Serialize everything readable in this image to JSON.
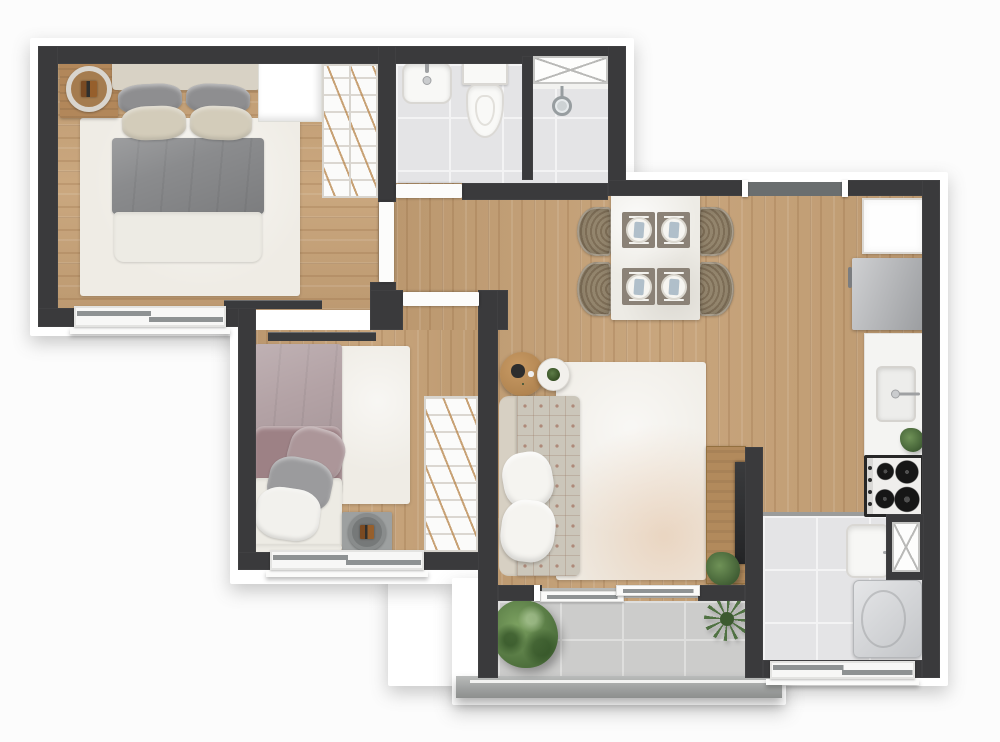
{
  "meta": {
    "type": "apartment-floor-plan",
    "canvas_width": 1000,
    "canvas_height": 742
  },
  "palette": {
    "background": "#fcfcfc",
    "wall": "#3a3a3c",
    "wood_floor": "#c5a075",
    "bathroom_tile": "#e4e4e6",
    "balcony_tile": "#cccccb",
    "rug": "#efece5",
    "sofa": "#cbc6ba",
    "bed1_duvet": "#8a8b8d",
    "bed2_duvet": "#b3a2a5",
    "plant_green": "#4d6f3c",
    "fixture_white": "#f8f8f6",
    "entry_mat": "#6a6e6f"
  },
  "scene": [
    {
      "n": "block-bedroom1-bath-backing",
      "c": "backing",
      "x": 30,
      "y": 38,
      "w": 604,
      "h": 298,
      "z": 1
    },
    {
      "n": "block-living-backing",
      "c": "backing",
      "x": 388,
      "y": 172,
      "w": 560,
      "h": 514,
      "z": 1
    },
    {
      "n": "block-bedroom2-backing",
      "c": "backing",
      "x": 230,
      "y": 300,
      "w": 276,
      "h": 284,
      "z": 1
    },
    {
      "n": "block-balcony-backing",
      "c": "backing",
      "x": 452,
      "y": 578,
      "w": 334,
      "h": 127,
      "z": 1
    },
    {
      "n": "bedroom1-floor",
      "c": "wood-h",
      "x": 58,
      "y": 64,
      "w": 320,
      "h": 246,
      "z": 4
    },
    {
      "n": "bathroom-floor",
      "c": "tile",
      "x": 396,
      "y": 64,
      "w": 212,
      "h": 120,
      "z": 4
    },
    {
      "n": "hall-living-kitchen-floor",
      "c": "wood-v",
      "x": 396,
      "y": 183,
      "w": 526,
      "h": 335,
      "z": 4
    },
    {
      "n": "living-floor-south",
      "c": "wood-v",
      "x": 478,
      "y": 518,
      "w": 267,
      "h": 84,
      "z": 4
    },
    {
      "n": "bedroom2-floor",
      "c": "wood-v",
      "x": 256,
      "y": 330,
      "w": 222,
      "h": 224,
      "z": 4
    },
    {
      "n": "bedroom1-door-floor",
      "c": "wood-v",
      "x": 378,
      "y": 200,
      "w": 18,
      "h": 84,
      "z": 4
    },
    {
      "n": "service-floor",
      "c": "tile",
      "x": 763,
      "y": 516,
      "w": 159,
      "h": 146,
      "z": 4
    },
    {
      "n": "kitchen-service-transition",
      "c": "strip",
      "x": 763,
      "y": 512,
      "w": 159,
      "h": 4,
      "bg": "#9b9c9b",
      "z": 5
    },
    {
      "n": "balcony-floor",
      "c": "tile-balc",
      "x": 498,
      "y": 601,
      "w": 247,
      "h": 75,
      "z": 4
    },
    {
      "n": "bedroom1-rug",
      "c": "rug",
      "x": 80,
      "y": 118,
      "w": 220,
      "h": 178,
      "z": 6
    },
    {
      "n": "bedroom2-rug",
      "c": "rug",
      "x": 338,
      "y": 346,
      "w": 72,
      "h": 158,
      "z": 6
    },
    {
      "n": "living-rug",
      "c": "rug rug-living",
      "x": 556,
      "y": 362,
      "w": 150,
      "h": 218,
      "z": 6
    },
    {
      "n": "balcony-railing",
      "c": "railing",
      "x": 456,
      "y": 676,
      "w": 326,
      "h": 22,
      "z": 8
    },
    {
      "n": "nightstand-bedroom1",
      "c": "ns-wood",
      "x": 60,
      "y": 60,
      "w": 58,
      "h": 58,
      "z": 10
    },
    {
      "n": "nightstand1-tray",
      "c": "ring",
      "x": 66,
      "y": 66,
      "w": 46,
      "h": 46,
      "z": 11
    },
    {
      "n": "bed1-headboard",
      "c": "headboard",
      "x": 112,
      "y": 56,
      "w": 148,
      "h": 34,
      "z": 10
    },
    {
      "n": "bed1-pillow-gray-left",
      "c": "pillow",
      "x": 118,
      "y": 84,
      "w": 64,
      "h": 30,
      "bg": "#8e8e90",
      "rot": -3,
      "z": 10
    },
    {
      "n": "bed1-pillow-gray-right",
      "c": "pillow",
      "x": 186,
      "y": 84,
      "w": 64,
      "h": 30,
      "bg": "#8e8e90",
      "rot": 3,
      "z": 10
    },
    {
      "n": "bed1-pillow-beige-left",
      "c": "pillow",
      "x": 122,
      "y": 106,
      "w": 64,
      "h": 34,
      "bg": "#d3ccba",
      "rot": -2,
      "z": 11
    },
    {
      "n": "bed1-pillow-beige-right",
      "c": "pillow",
      "x": 190,
      "y": 106,
      "w": 62,
      "h": 34,
      "bg": "#d3ccba",
      "rot": 2,
      "z": 11
    },
    {
      "n": "bed1-duvet",
      "c": "duvet",
      "x": 112,
      "y": 138,
      "w": 152,
      "h": 76,
      "bg": "#8a8b8d",
      "z": 10
    },
    {
      "n": "bed1-sheet",
      "c": "sheet",
      "x": 114,
      "y": 212,
      "w": 148,
      "h": 50,
      "z": 10
    },
    {
      "n": "bedroom1-shelf",
      "c": "shelfbox",
      "x": 258,
      "y": 60,
      "w": 64,
      "h": 62,
      "z": 10
    },
    {
      "n": "bedroom1-wardrobe",
      "c": "wardrobe",
      "x": 322,
      "y": 64,
      "w": 56,
      "h": 134,
      "z": 10
    },
    {
      "n": "bedroom1-wardrobe-divider",
      "c": "vline",
      "x": 349,
      "y": 66,
      "w": 2,
      "h": 130,
      "z": 11
    },
    {
      "n": "bedroom1-tv",
      "c": "tv-bar",
      "x": 224,
      "y": 300,
      "w": 98,
      "h": 9,
      "z": 12
    },
    {
      "n": "bathroom-sink",
      "c": "sink-bath",
      "x": 402,
      "y": 62,
      "w": 50,
      "h": 42,
      "z": 10
    },
    {
      "n": "toilet-tank",
      "c": "toilet-tank",
      "x": 462,
      "y": 59,
      "w": 46,
      "h": 26,
      "z": 10
    },
    {
      "n": "toilet-bowl",
      "c": "toilet-bowl",
      "x": 466,
      "y": 84,
      "w": 38,
      "h": 54,
      "z": 10
    },
    {
      "n": "shower-threshold",
      "c": "strip",
      "x": 533,
      "y": 84,
      "w": 75,
      "h": 5,
      "bg": "#f2f2f0",
      "z": 11
    },
    {
      "n": "shower-head",
      "c": "shower-head",
      "x": 552,
      "y": 96,
      "w": 20,
      "h": 20,
      "z": 12
    },
    {
      "n": "dining-chair-left-1",
      "c": "chair-left",
      "x": 577,
      "y": 207,
      "w": 35,
      "h": 49,
      "z": 10
    },
    {
      "n": "dining-chair-left-2",
      "c": "chair-left",
      "x": 577,
      "y": 262,
      "w": 35,
      "h": 54,
      "z": 10
    },
    {
      "n": "dining-chair-right-1",
      "c": "chair-right",
      "x": 698,
      "y": 207,
      "w": 36,
      "h": 49,
      "z": 10
    },
    {
      "n": "dining-chair-right-2",
      "c": "chair-right",
      "x": 698,
      "y": 262,
      "w": 36,
      "h": 54,
      "z": 10
    },
    {
      "n": "dining-table",
      "c": "table-top",
      "x": 611,
      "y": 194,
      "w": 89,
      "h": 126,
      "z": 11
    },
    {
      "n": "place-setting-1",
      "c": "placemat",
      "x": 622,
      "y": 212,
      "w": 33,
      "h": 36,
      "z": 12
    },
    {
      "n": "place-setting-2",
      "c": "placemat",
      "x": 657,
      "y": 212,
      "w": 33,
      "h": 36,
      "z": 12
    },
    {
      "n": "place-setting-3",
      "c": "placemat",
      "x": 622,
      "y": 268,
      "w": 33,
      "h": 37,
      "z": 12
    },
    {
      "n": "place-setting-4",
      "c": "placemat",
      "x": 657,
      "y": 268,
      "w": 33,
      "h": 37,
      "z": 12
    },
    {
      "n": "side-table-wood",
      "c": "round-wood",
      "x": 500,
      "y": 352,
      "w": 44,
      "h": 44,
      "z": 10
    },
    {
      "n": "side-table-white",
      "c": "round-white",
      "x": 537,
      "y": 358,
      "w": 33,
      "h": 33,
      "z": 11
    },
    {
      "n": "sofa-back",
      "c": "sofa-back",
      "x": 499,
      "y": 396,
      "w": 20,
      "h": 180,
      "z": 10
    },
    {
      "n": "sofa-seat",
      "c": "sofa-tuft",
      "x": 517,
      "y": 396,
      "w": 63,
      "h": 180,
      "z": 10
    },
    {
      "n": "sofa-pillow-1",
      "c": "pillow-big",
      "x": 503,
      "y": 452,
      "w": 50,
      "h": 56,
      "rot": -10,
      "z": 11
    },
    {
      "n": "sofa-pillow-2",
      "c": "pillow-big",
      "x": 501,
      "y": 500,
      "w": 54,
      "h": 62,
      "rot": 7,
      "z": 11
    },
    {
      "n": "tv-console",
      "c": "console",
      "x": 706,
      "y": 446,
      "w": 40,
      "h": 138,
      "z": 10
    },
    {
      "n": "living-tv",
      "c": "tv-screen",
      "x": 735,
      "y": 462,
      "w": 12,
      "h": 102,
      "z": 11
    },
    {
      "n": "console-plant",
      "c": "plant-small",
      "x": 706,
      "y": 552,
      "w": 34,
      "h": 34,
      "z": 12
    },
    {
      "n": "kitchen-cabinet",
      "c": "cabinet",
      "x": 862,
      "y": 198,
      "w": 62,
      "h": 56,
      "z": 10
    },
    {
      "n": "refrigerator",
      "c": "fridge",
      "x": 852,
      "y": 258,
      "w": 72,
      "h": 72,
      "z": 10
    },
    {
      "n": "kitchen-counter",
      "c": "counter",
      "x": 864,
      "y": 333,
      "w": 60,
      "h": 124,
      "z": 10
    },
    {
      "n": "kitchen-sink",
      "c": "sink-k",
      "x": 876,
      "y": 366,
      "w": 40,
      "h": 56,
      "z": 11
    },
    {
      "n": "kitchen-plant",
      "c": "plant-small",
      "x": 900,
      "y": 428,
      "w": 24,
      "h": 24,
      "z": 12
    },
    {
      "n": "stove",
      "c": "stove",
      "x": 864,
      "y": 455,
      "w": 60,
      "h": 62,
      "z": 12
    },
    {
      "n": "laundry-tank",
      "c": "tank",
      "x": 846,
      "y": 524,
      "w": 44,
      "h": 54,
      "z": 10
    },
    {
      "n": "washing-machine",
      "c": "washer",
      "x": 853,
      "y": 580,
      "w": 69,
      "h": 78,
      "z": 10
    },
    {
      "n": "balcony-bush",
      "c": "plant-bush",
      "x": 492,
      "y": 600,
      "w": 66,
      "h": 68,
      "z": 12
    },
    {
      "n": "balcony-plant-spiky",
      "c": "plant-spiky",
      "x": 704,
      "y": 597,
      "w": 46,
      "h": 44,
      "z": 12
    },
    {
      "n": "bedroom2-tv",
      "c": "tv-bar",
      "x": 268,
      "y": 332,
      "w": 108,
      "h": 9,
      "z": 12
    },
    {
      "n": "bed2-duvet",
      "c": "duvet",
      "x": 254,
      "y": 344,
      "w": 88,
      "h": 142,
      "bg": "#b3a2a5",
      "z": 10
    },
    {
      "n": "bed2-duvet-fold",
      "c": "pillow",
      "x": 254,
      "y": 426,
      "w": 88,
      "h": 72,
      "bg": "#9d8185",
      "rad": "10px",
      "z": 10
    },
    {
      "n": "bed2-sheet",
      "c": "sheet",
      "x": 254,
      "y": 478,
      "w": 88,
      "h": 76,
      "z": 10
    },
    {
      "n": "bed2-pillow-mauve",
      "c": "pillow",
      "x": 288,
      "y": 428,
      "w": 56,
      "h": 52,
      "bg": "#ac9699",
      "rot": 16,
      "z": 11
    },
    {
      "n": "bed2-pillow-gray",
      "c": "pillow",
      "x": 268,
      "y": 458,
      "w": 64,
      "h": 52,
      "bg": "#9b9b9d",
      "rot": 12,
      "z": 11
    },
    {
      "n": "bed2-pillow-white",
      "c": "pillow",
      "x": 256,
      "y": 488,
      "w": 64,
      "h": 52,
      "bg": "#f2f1ed",
      "rot": 8,
      "z": 11
    },
    {
      "n": "bed2-headboard",
      "c": "sheet",
      "x": 254,
      "y": 544,
      "w": 88,
      "h": 12,
      "z": 11
    },
    {
      "n": "nightstand-bedroom2",
      "c": "ns-gray",
      "x": 342,
      "y": 512,
      "w": 50,
      "h": 42,
      "z": 10
    },
    {
      "n": "nightstand2-tray",
      "c": "ring2",
      "x": 348,
      "y": 513,
      "w": 38,
      "h": 38,
      "z": 11
    },
    {
      "n": "bedroom2-wardrobe",
      "c": "wardrobe",
      "x": 424,
      "y": 396,
      "w": 54,
      "h": 156,
      "z": 10
    },
    {
      "n": "wall-north",
      "c": "wall",
      "x": 38,
      "y": 46,
      "w": 587,
      "h": 18,
      "z": 30
    },
    {
      "n": "wall-west",
      "c": "wall",
      "x": 38,
      "y": 46,
      "w": 20,
      "h": 281,
      "z": 30
    },
    {
      "n": "wall-bedroom1-south",
      "c": "wall",
      "x": 38,
      "y": 308,
      "w": 202,
      "h": 19,
      "z": 30
    },
    {
      "n": "wall-bedroom2-west",
      "c": "wall",
      "x": 238,
      "y": 308,
      "w": 18,
      "h": 262,
      "z": 30
    },
    {
      "n": "wall-bedroom1-east",
      "c": "wall",
      "x": 378,
      "y": 46,
      "w": 18,
      "h": 156,
      "z": 30
    },
    {
      "n": "wall-hall-stub",
      "c": "wall",
      "x": 370,
      "y": 282,
      "w": 26,
      "h": 28,
      "z": 30
    },
    {
      "n": "wall-hall-south-left",
      "c": "wall",
      "x": 370,
      "y": 290,
      "w": 33,
      "h": 40,
      "z": 30
    },
    {
      "n": "wall-hall-south-right",
      "c": "wall",
      "x": 479,
      "y": 290,
      "w": 29,
      "h": 40,
      "z": 30
    },
    {
      "n": "wall-bedroom2-south",
      "c": "wall",
      "x": 238,
      "y": 552,
      "w": 260,
      "h": 18,
      "z": 30
    },
    {
      "n": "wall-living-west",
      "c": "wall",
      "x": 478,
      "y": 290,
      "w": 20,
      "h": 388,
      "z": 30
    },
    {
      "n": "wall-bathroom-east",
      "c": "wall",
      "x": 608,
      "y": 46,
      "w": 18,
      "h": 150,
      "z": 30
    },
    {
      "n": "wall-living-north-left",
      "c": "wall",
      "x": 608,
      "y": 180,
      "w": 140,
      "h": 16,
      "z": 30
    },
    {
      "n": "wall-living-north-right",
      "c": "wall",
      "x": 842,
      "y": 180,
      "w": 98,
      "h": 16,
      "z": 30
    },
    {
      "n": "wall-east",
      "c": "wall",
      "x": 922,
      "y": 180,
      "w": 18,
      "h": 498,
      "z": 30
    },
    {
      "n": "wall-bathroom-south",
      "c": "wall",
      "x": 462,
      "y": 183,
      "w": 146,
      "h": 17,
      "z": 30
    },
    {
      "n": "wall-service-west",
      "c": "wall",
      "x": 745,
      "y": 447,
      "w": 18,
      "h": 231,
      "z": 30
    },
    {
      "n": "wall-service-south",
      "c": "wall",
      "x": 763,
      "y": 660,
      "w": 159,
      "h": 18,
      "z": 30
    },
    {
      "n": "wall-balcony-door-left",
      "c": "wall",
      "x": 498,
      "y": 585,
      "w": 44,
      "h": 16,
      "z": 30
    },
    {
      "n": "wall-balcony-door-right",
      "c": "wall",
      "x": 698,
      "y": 585,
      "w": 47,
      "h": 16,
      "z": 30
    },
    {
      "n": "wall-shower-divider",
      "c": "wall",
      "x": 522,
      "y": 56,
      "w": 11,
      "h": 124,
      "z": 30
    },
    {
      "n": "wall-duct-surround",
      "c": "wall",
      "x": 886,
      "y": 514,
      "w": 38,
      "h": 66,
      "z": 30
    },
    {
      "n": "bathroom-duct-shaft",
      "c": "xbox",
      "x": 533,
      "y": 56,
      "w": 75,
      "h": 28,
      "z": 34
    },
    {
      "n": "service-duct-shaft",
      "c": "xbox",
      "x": 892,
      "y": 522,
      "w": 28,
      "h": 50,
      "z": 34
    },
    {
      "n": "bedroom1-door",
      "c": "door-leaf",
      "x": 379,
      "y": 202,
      "w": 15,
      "h": 80,
      "z": 34
    },
    {
      "n": "bathroom-door",
      "c": "door-leaf",
      "x": 396,
      "y": 184,
      "w": 66,
      "h": 14,
      "z": 34
    },
    {
      "n": "bedroom2-door",
      "c": "door-leaf",
      "x": 403,
      "y": 292,
      "w": 76,
      "h": 14,
      "z": 34
    },
    {
      "n": "entry-threshold",
      "c": "mat",
      "x": 748,
      "y": 182,
      "w": 94,
      "h": 14,
      "z": 32
    },
    {
      "n": "entry-jamb-left",
      "c": "cap",
      "x": 742,
      "y": 180,
      "w": 6,
      "h": 17,
      "z": 36
    },
    {
      "n": "entry-jamb-right",
      "c": "cap",
      "x": 842,
      "y": 180,
      "w": 6,
      "h": 17,
      "z": 36
    },
    {
      "n": "bedroom1-window",
      "c": "window-h",
      "x": 74,
      "y": 306,
      "w": 152,
      "h": 21,
      "z": 34
    },
    {
      "n": "bedroom1-window-sill",
      "c": "sill",
      "x": 70,
      "y": 327,
      "w": 160,
      "h": 7,
      "z": 33
    },
    {
      "n": "bedroom2-window",
      "c": "window-h",
      "x": 270,
      "y": 550,
      "w": 154,
      "h": 20,
      "z": 34
    },
    {
      "n": "bedroom2-window-sill",
      "c": "sill",
      "x": 266,
      "y": 570,
      "w": 162,
      "h": 7,
      "z": 33
    },
    {
      "n": "service-window",
      "c": "window-h",
      "x": 770,
      "y": 661,
      "w": 145,
      "h": 18,
      "z": 34
    },
    {
      "n": "service-window-sill",
      "c": "sill",
      "x": 766,
      "y": 679,
      "w": 153,
      "h": 6,
      "z": 33
    },
    {
      "n": "balcony-door-track",
      "c": "strip",
      "x": 542,
      "y": 588,
      "w": 156,
      "h": 10,
      "bg": "#b7b8b6",
      "z": 33
    },
    {
      "n": "balcony-door-panel-left",
      "c": "glass-panel",
      "x": 540,
      "y": 591,
      "w": 84,
      "h": 11,
      "z": 34
    },
    {
      "n": "balcony-door-panel-right",
      "c": "glass-panel",
      "x": 616,
      "y": 585,
      "w": 84,
      "h": 11,
      "z": 34
    },
    {
      "n": "balcony-door-jamb",
      "c": "cap",
      "x": 534,
      "y": 585,
      "w": 6,
      "h": 16,
      "z": 36
    }
  ]
}
